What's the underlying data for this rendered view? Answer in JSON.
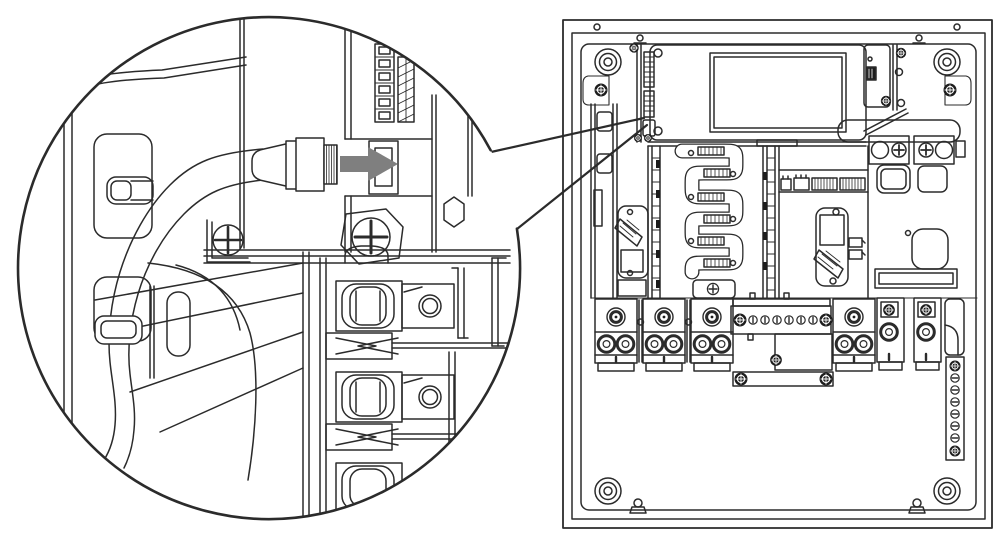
{
  "figure": {
    "kind": "technical-line-illustration",
    "aria_label": "Installation diagram: magnified callout showing a communication cable RJ45 connector being inserted into the communication port beside the display board inside an inverter wiring compartment",
    "background": "#ffffff",
    "line_color": "#2b2b2b",
    "arrow_color": "#7f7f7f"
  },
  "callout": {
    "name": "magnified-detail",
    "parts": [
      "side-panel-cutouts",
      "communication-cable",
      "cable-clamp",
      "rj45-connector",
      "insertion-arrow",
      "rj45-port",
      "terminal-strip-cage",
      "terminal-strip-screws",
      "phillips-screw-left",
      "phillips-screw-right",
      "hex-standoff",
      "breaker-lug-terminals"
    ]
  },
  "enclosure": {
    "name": "inverter-wiring-compartment",
    "parts": [
      "outer-frame",
      "corner-bosses",
      "corner-screws",
      "display-board",
      "comm-board-connectors",
      "aux-board",
      "dc-terminal-lugs",
      "heatsink-busbar",
      "breaker-switch-left",
      "breaker-switch-right",
      "connector-headers",
      "knockout",
      "cable-slot",
      "terminal-blocks",
      "neutral-busbar",
      "shunt-box",
      "lower-bar",
      "fuse-blocks",
      "flag-bracket",
      "ground-busbar",
      "bottom-clips"
    ]
  }
}
